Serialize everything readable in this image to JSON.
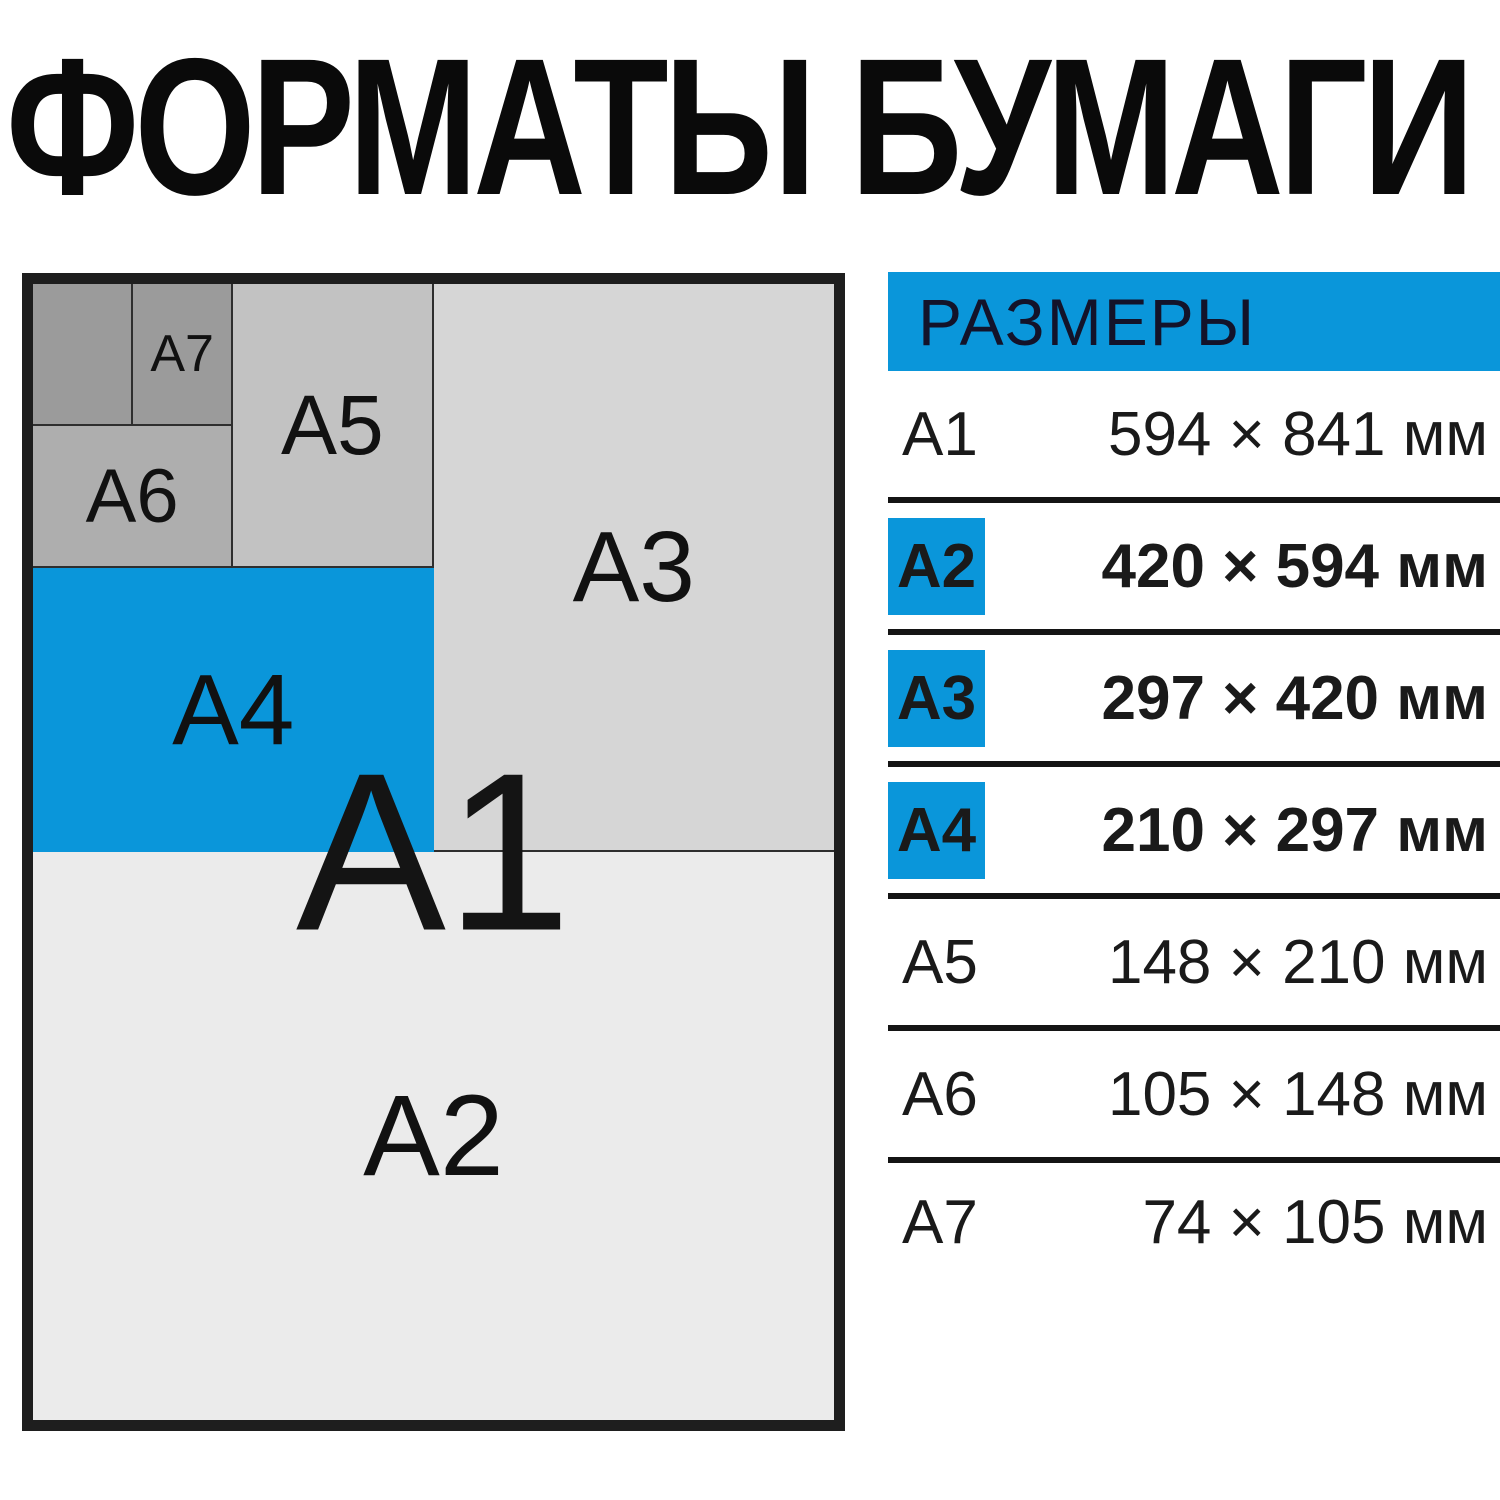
{
  "title": "ФОРМАТЫ БУМАГИ",
  "colors": {
    "accent_blue": "#0a96da",
    "divider_black": "#141414",
    "gray_a7_a8": "#9b9b9b",
    "gray_a6": "#aeaeae",
    "gray_a5": "#c2c2c2",
    "gray_a3": "#d6d6d6",
    "gray_a2": "#ebebeb"
  },
  "diagram": {
    "overlay_label": "A1",
    "labels": {
      "a2": "A2",
      "a3": "A3",
      "a4": "A4",
      "a5": "A5",
      "a6": "A6",
      "a7": "A7"
    }
  },
  "table": {
    "header": "РАЗМЕРЫ",
    "rows": [
      {
        "format": "A1",
        "size": "594 × 841 мм"
      },
      {
        "format": "A2",
        "size": "420 × 594 мм"
      },
      {
        "format": "A3",
        "size": "297 × 420 мм"
      },
      {
        "format": "A4",
        "size": "210 × 297 мм"
      },
      {
        "format": "A5",
        "size": "148 × 210 мм"
      },
      {
        "format": "A6",
        "size": "105 × 148 мм"
      },
      {
        "format": "A7",
        "size": "74 × 105 мм"
      }
    ]
  }
}
